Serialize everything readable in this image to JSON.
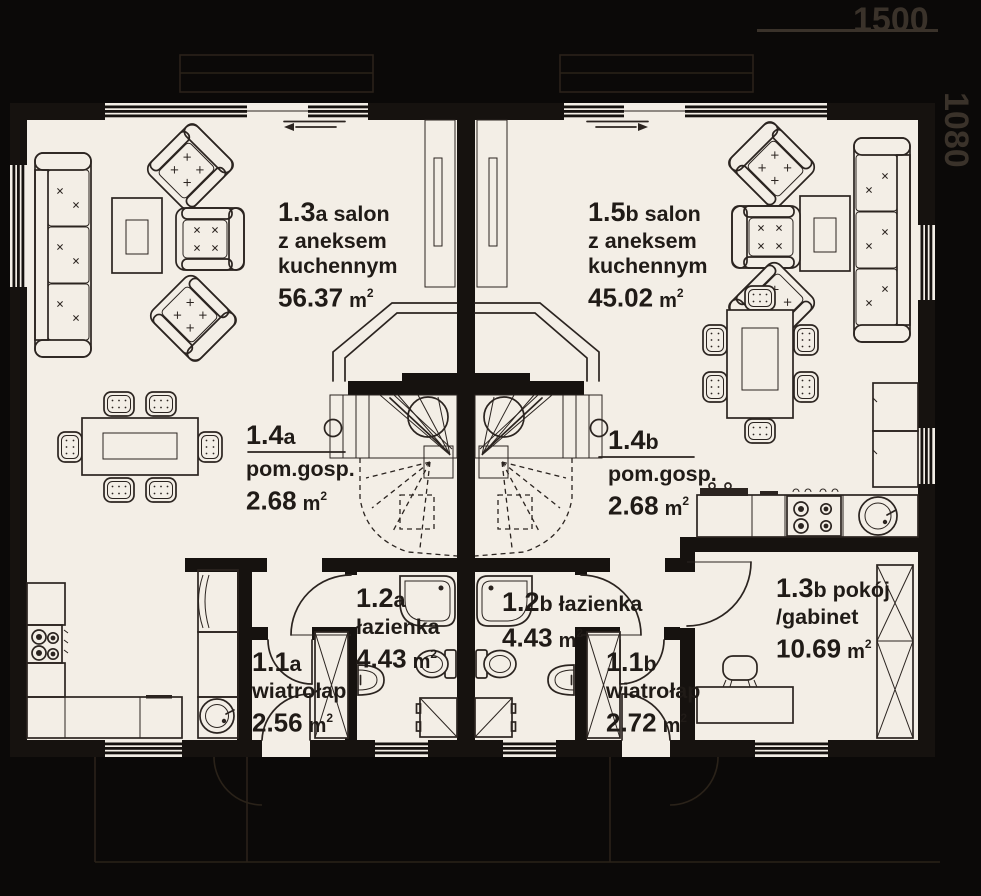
{
  "dimensions": {
    "width_label": "1500",
    "height_label": "1080"
  },
  "units": {
    "area_unit": "m",
    "area_sup": "2"
  },
  "rooms": {
    "salon_a": {
      "number": "1.3",
      "suffix": "a salon",
      "line2": "z aneksem",
      "line3": "kuchennym",
      "area": "56.37"
    },
    "salon_b": {
      "number": "1.5",
      "suffix": "b salon",
      "line2": "z aneksem",
      "line3": "kuchennym",
      "area": "45.02"
    },
    "pom_a": {
      "number": "1.4",
      "suffix": "a",
      "line2": "pom.gosp.",
      "area": "2.68"
    },
    "pom_b": {
      "number": "1.4",
      "suffix": "b",
      "line2": "pom.gosp.",
      "area": "2.68"
    },
    "laz_a": {
      "number": "1.2",
      "suffix": "a",
      "line2": "łazienka",
      "area": "4.43"
    },
    "laz_b": {
      "number": "1.2",
      "suffix": "b łazienka",
      "area": "4.43"
    },
    "wia_a": {
      "number": "1.1",
      "suffix": "a",
      "line2": "wiatrołap",
      "area": "2.56"
    },
    "wia_b": {
      "number": "1.1",
      "suffix": "b",
      "line2": "wiatrołap",
      "area": "2.72"
    },
    "pok_b": {
      "number": "1.3",
      "suffix": "b pokój",
      "line2": "/gabinet",
      "area": "10.69"
    }
  }
}
